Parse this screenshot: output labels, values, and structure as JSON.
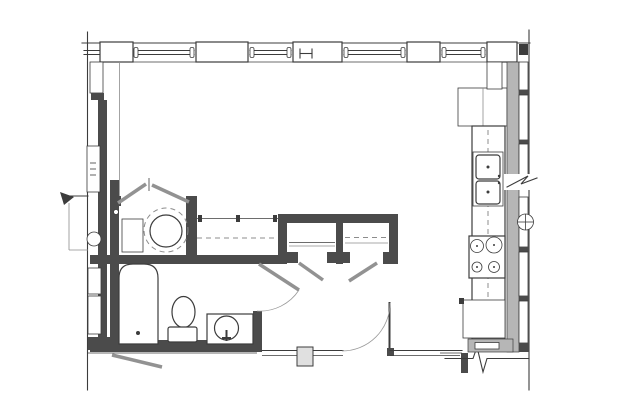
{
  "drawing": {
    "type": "architectural-floor-plan",
    "visible_text": [],
    "symbols": [
      "i-beam-column-symbol",
      "break-line-symbol",
      "pipe-symbol"
    ]
  },
  "colors": {
    "background": "#ffffff",
    "line": "#3c3c3c",
    "line_light": "#8c8c8c",
    "wall_fill": "#4b4b4b",
    "gray_wall": "#b6b6b6",
    "door_leaf": "#929292",
    "post_fill": "#e0e0e0"
  },
  "fixtures": {
    "kitchen": [
      "refrigerator",
      "kitchen-sink-double",
      "range-cooktop",
      "base-cabinet",
      "counter-dashed-centerline"
    ],
    "bathroom": [
      "bathtub",
      "toilet",
      "vanity-sink",
      "bathroom-door"
    ],
    "laundry_closet": [
      "bifold-doors",
      "washer-dryer",
      "shelf-unit"
    ],
    "closets": [
      "closet-rod",
      "rod-brackets",
      "shelf-line",
      "closet-door-left",
      "closet-door-right"
    ],
    "entry": [
      "entry-door",
      "wall-post"
    ],
    "envelope": [
      "north-window-band",
      "window-piers",
      "shaft-wall",
      "electrical-panel",
      "left-chase"
    ]
  }
}
